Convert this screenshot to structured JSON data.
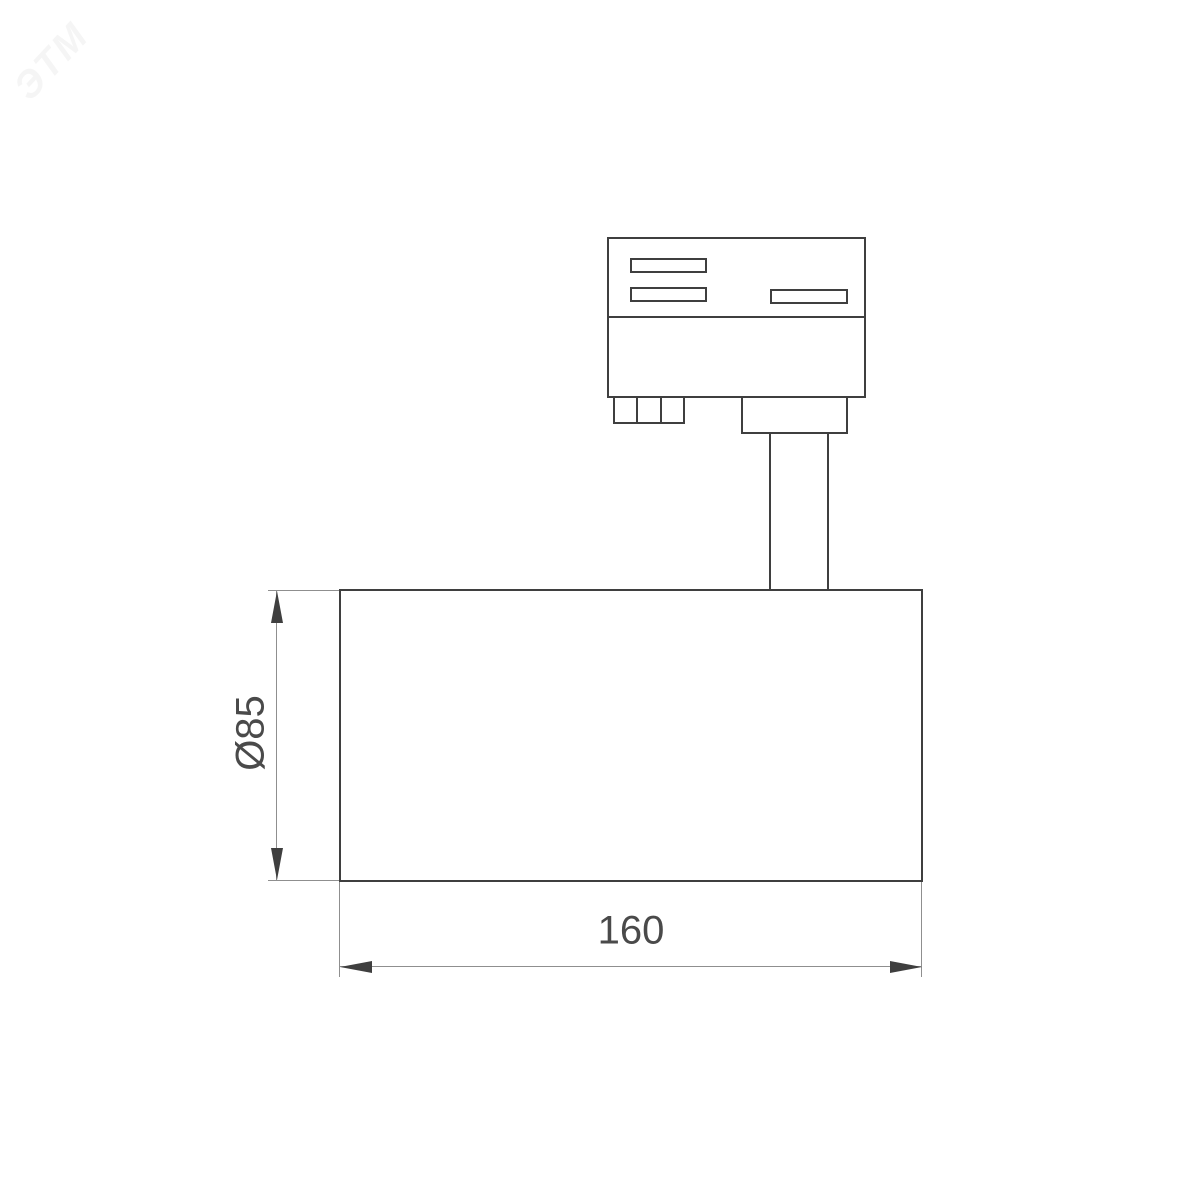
{
  "page": {
    "background": "#ffffff"
  },
  "watermark": {
    "text": "ЭТМ"
  },
  "drawing": {
    "type": "technical-dimension-drawing",
    "view": "side view of track-mounted spotlight",
    "dimensions": {
      "diameter": {
        "label": "Ø85",
        "orientation": "vertical"
      },
      "length": {
        "label": "160",
        "orientation": "horizontal"
      }
    },
    "colors": {
      "outline": "#3f3f3f",
      "dimension_line": "#8f8f8f",
      "arrow": "#3f3f3f",
      "text": "#4a4a4a",
      "background": "#ffffff"
    }
  }
}
